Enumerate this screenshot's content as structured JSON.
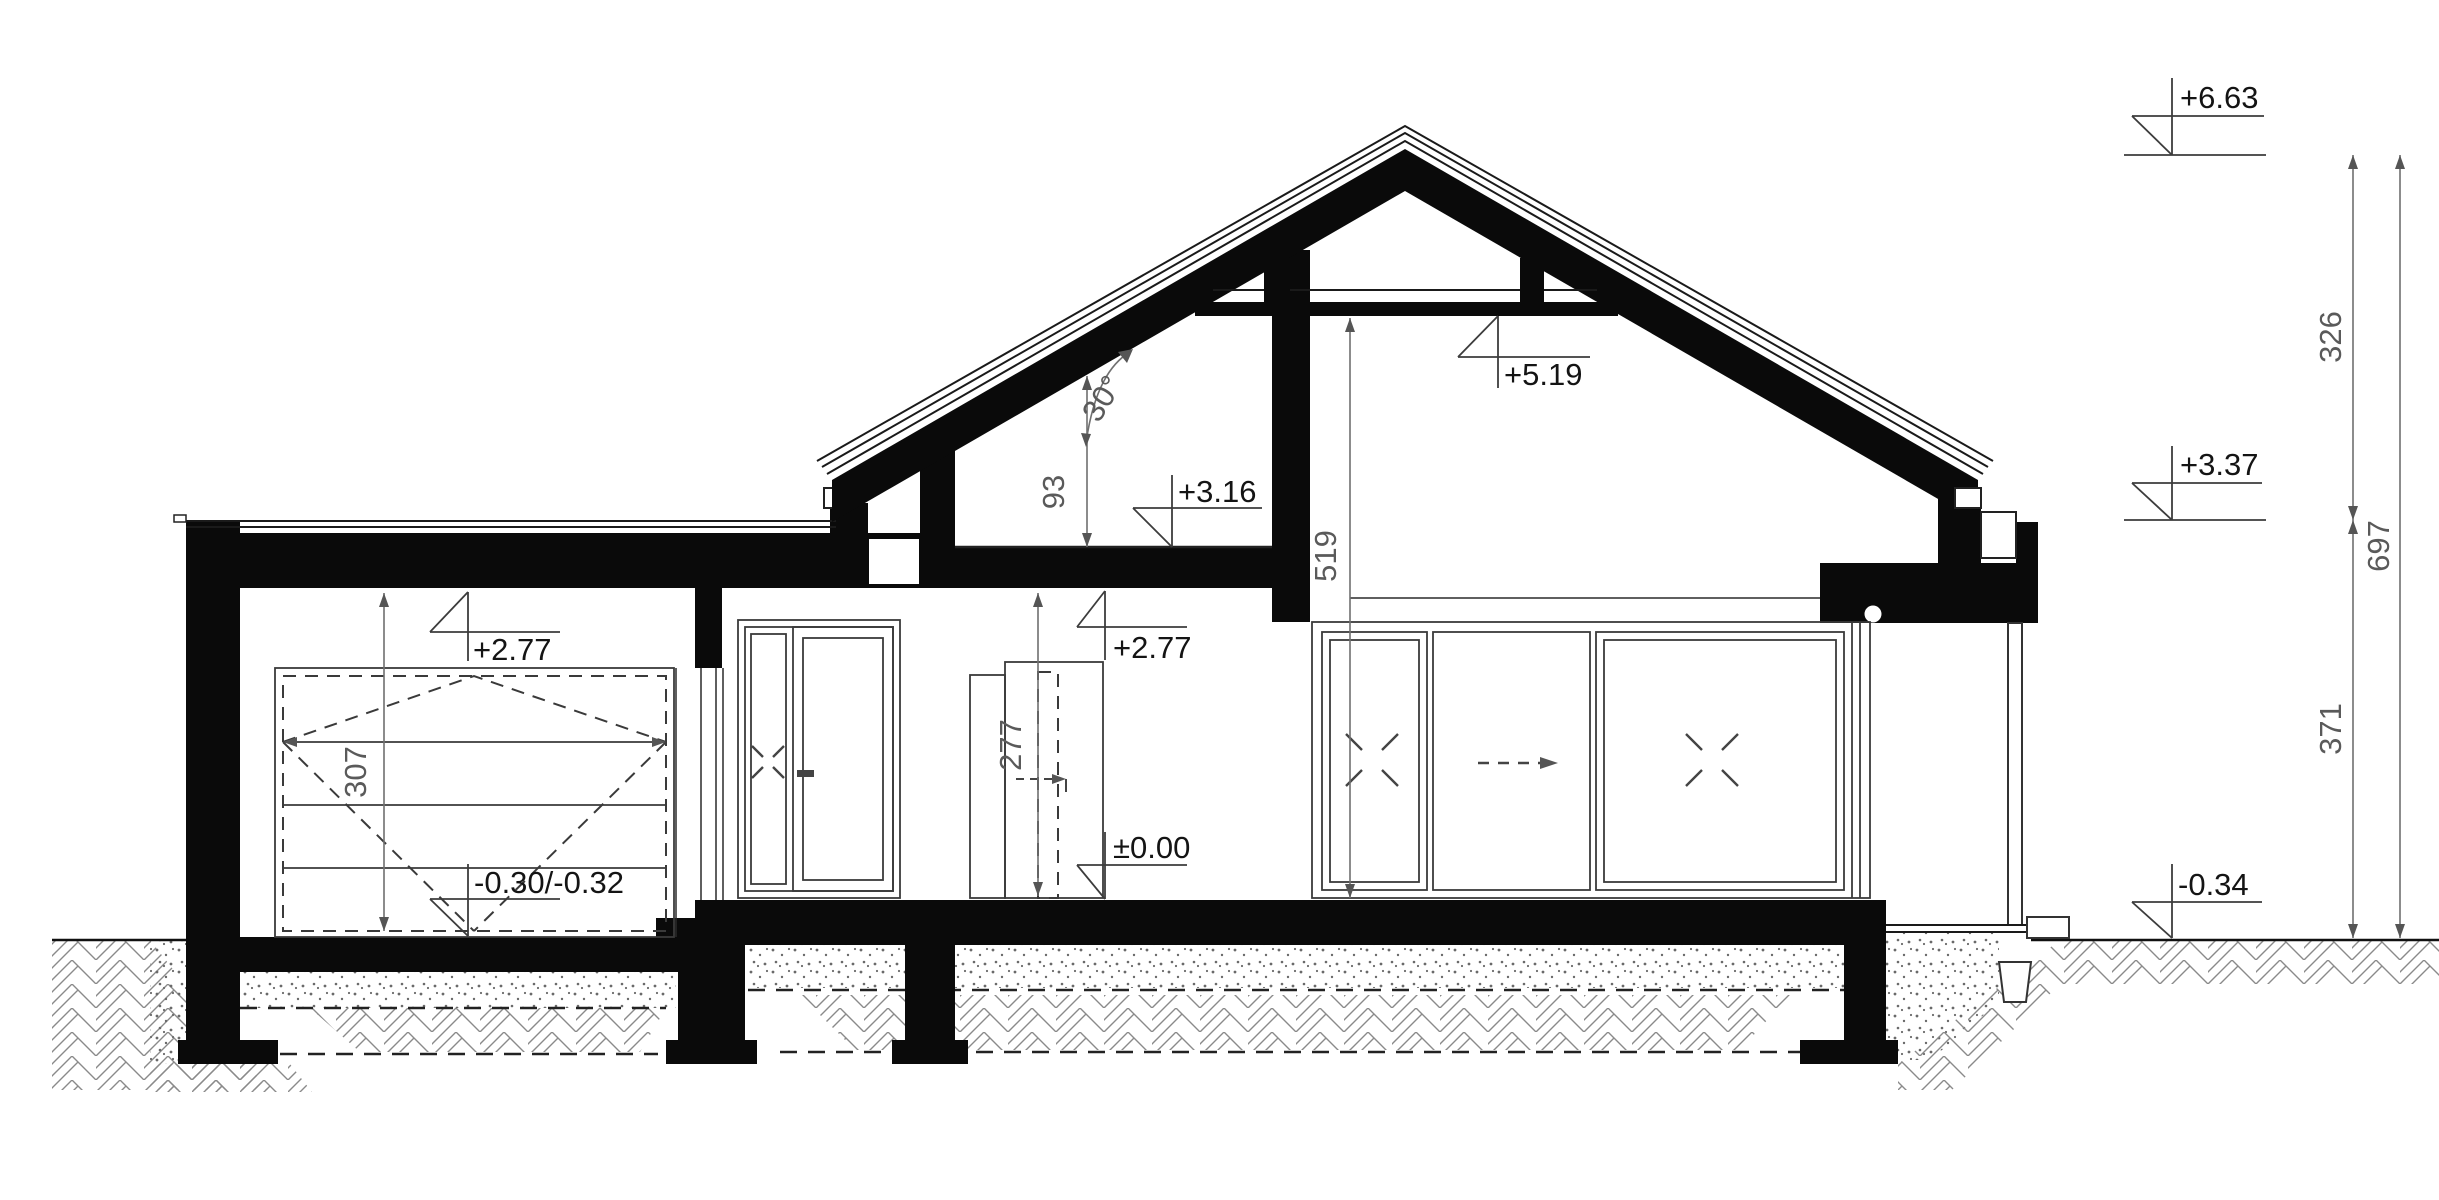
{
  "drawing": {
    "type": "house-cross-section",
    "units": "cm / m",
    "roof_pitch_deg": 30,
    "levels": {
      "ridge": "+6.63",
      "eave": "+3.37",
      "terrain": "-0.34",
      "collar_ceiling": "+5.19",
      "attic_floor": "+3.16",
      "garage_ceiling": "+2.77",
      "hall_ceiling": "+2.77",
      "floor_zero": "±0.00",
      "garage_floor": "-0.30/-0.32"
    },
    "dimensions": {
      "ridge_to_eave": "326",
      "eave_to_terrain": "371",
      "ridge_to_terrain": "697",
      "living_room_height": "519",
      "hall_clear_height": "277",
      "garage_clear_height": "307",
      "attic_knee_height": "93",
      "roof_pitch": "30°"
    },
    "colors": {
      "ink": "#0a0a0a",
      "dimension": "#707070",
      "background": "#ffffff"
    }
  }
}
